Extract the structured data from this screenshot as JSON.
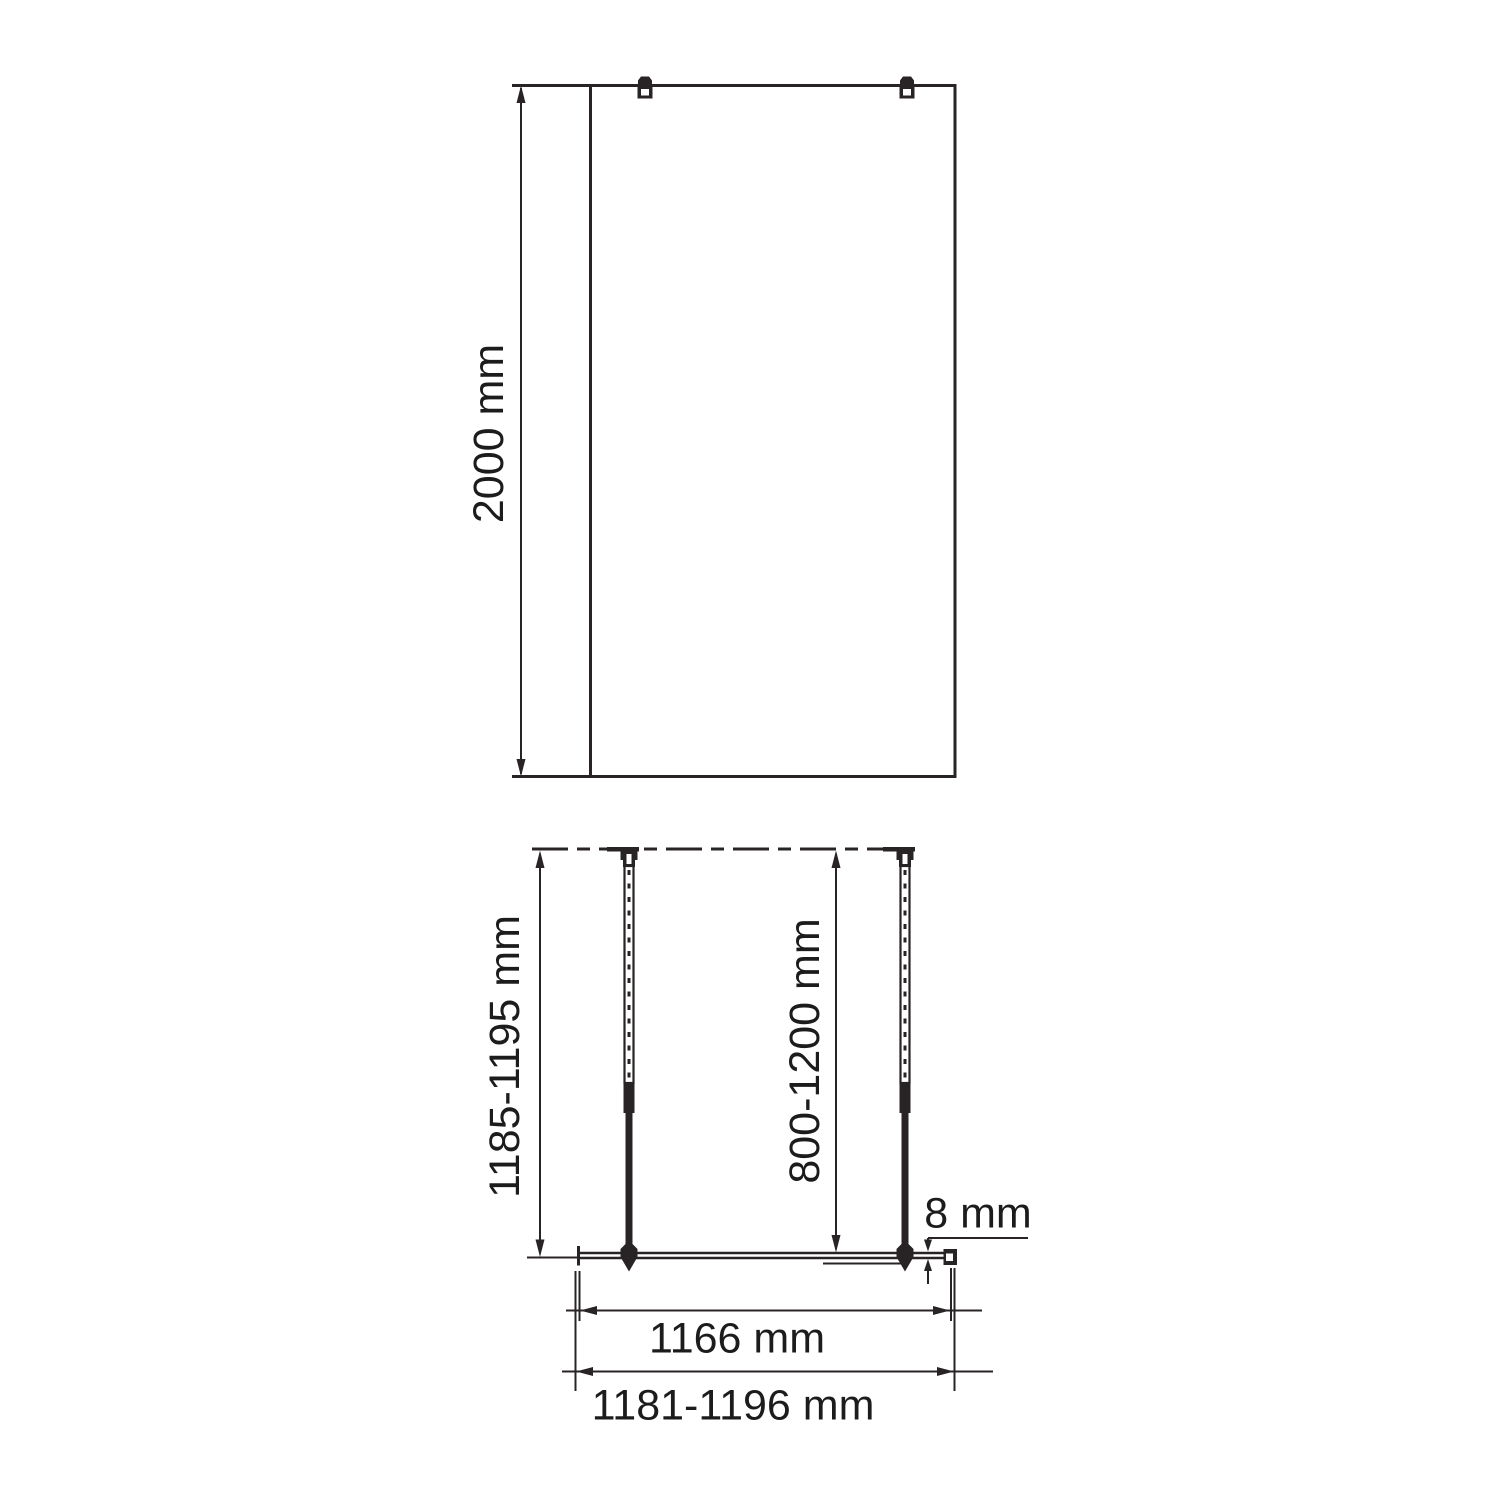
{
  "front_view": {
    "height_dimension": "2000 mm"
  },
  "plan_view": {
    "panel_depth_dimension": "1185-1195 mm",
    "support_bar_range_dimension": "800-1200 mm",
    "glass_thickness_dimension": "8 mm",
    "glass_width_dimension": "1166 mm",
    "overall_width_dimension": "1181-1196 mm"
  },
  "colors": {
    "line": "#282425",
    "text": "#1c1c1c",
    "background": "#ffffff"
  }
}
